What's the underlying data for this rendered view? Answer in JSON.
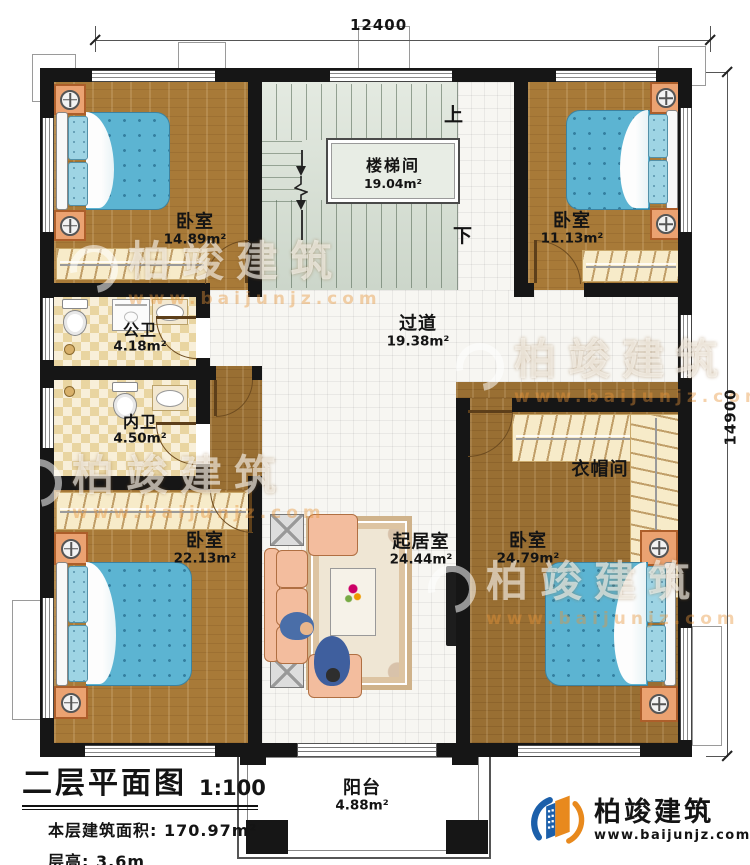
{
  "title_block": {
    "title": "二层平面图",
    "scale": "1:100",
    "area_label": "本层建筑面积:",
    "area_value": "170.97m²",
    "height_label": "层高:",
    "height_value": "3.6m"
  },
  "dims": {
    "top": "12400",
    "right": "14900"
  },
  "rooms": [
    {
      "id": "bedroom-nw",
      "name": "卧室",
      "area": "14.89m²"
    },
    {
      "id": "stairwell",
      "name": "楼梯间",
      "area": "19.04m²"
    },
    {
      "id": "bedroom-ne",
      "name": "卧室",
      "area": "11.13m²"
    },
    {
      "id": "bath-public",
      "name": "公卫",
      "area": "4.18m²"
    },
    {
      "id": "corridor",
      "name": "过道",
      "area": "19.38m²"
    },
    {
      "id": "bath-private",
      "name": "内卫",
      "area": "4.50m²"
    },
    {
      "id": "cloakroom",
      "name": "衣帽间"
    },
    {
      "id": "bedroom-sw",
      "name": "卧室",
      "area": "22.13m²"
    },
    {
      "id": "living",
      "name": "起居室",
      "area": "24.44m²"
    },
    {
      "id": "bedroom-se",
      "name": "卧室",
      "area": "24.79m²"
    },
    {
      "id": "balcony",
      "name": "阳台",
      "area": "4.88m²"
    }
  ],
  "stairs": {
    "up": "上",
    "down": "下"
  },
  "brand": {
    "name": "柏竣建筑",
    "url": "www.baijunjz.com"
  },
  "colors": {
    "wall": "#161616",
    "wood": "#a87a38",
    "bed": "#5cb4d2",
    "logo_blue": "#1b5faa",
    "logo_orange": "#e8891d"
  }
}
